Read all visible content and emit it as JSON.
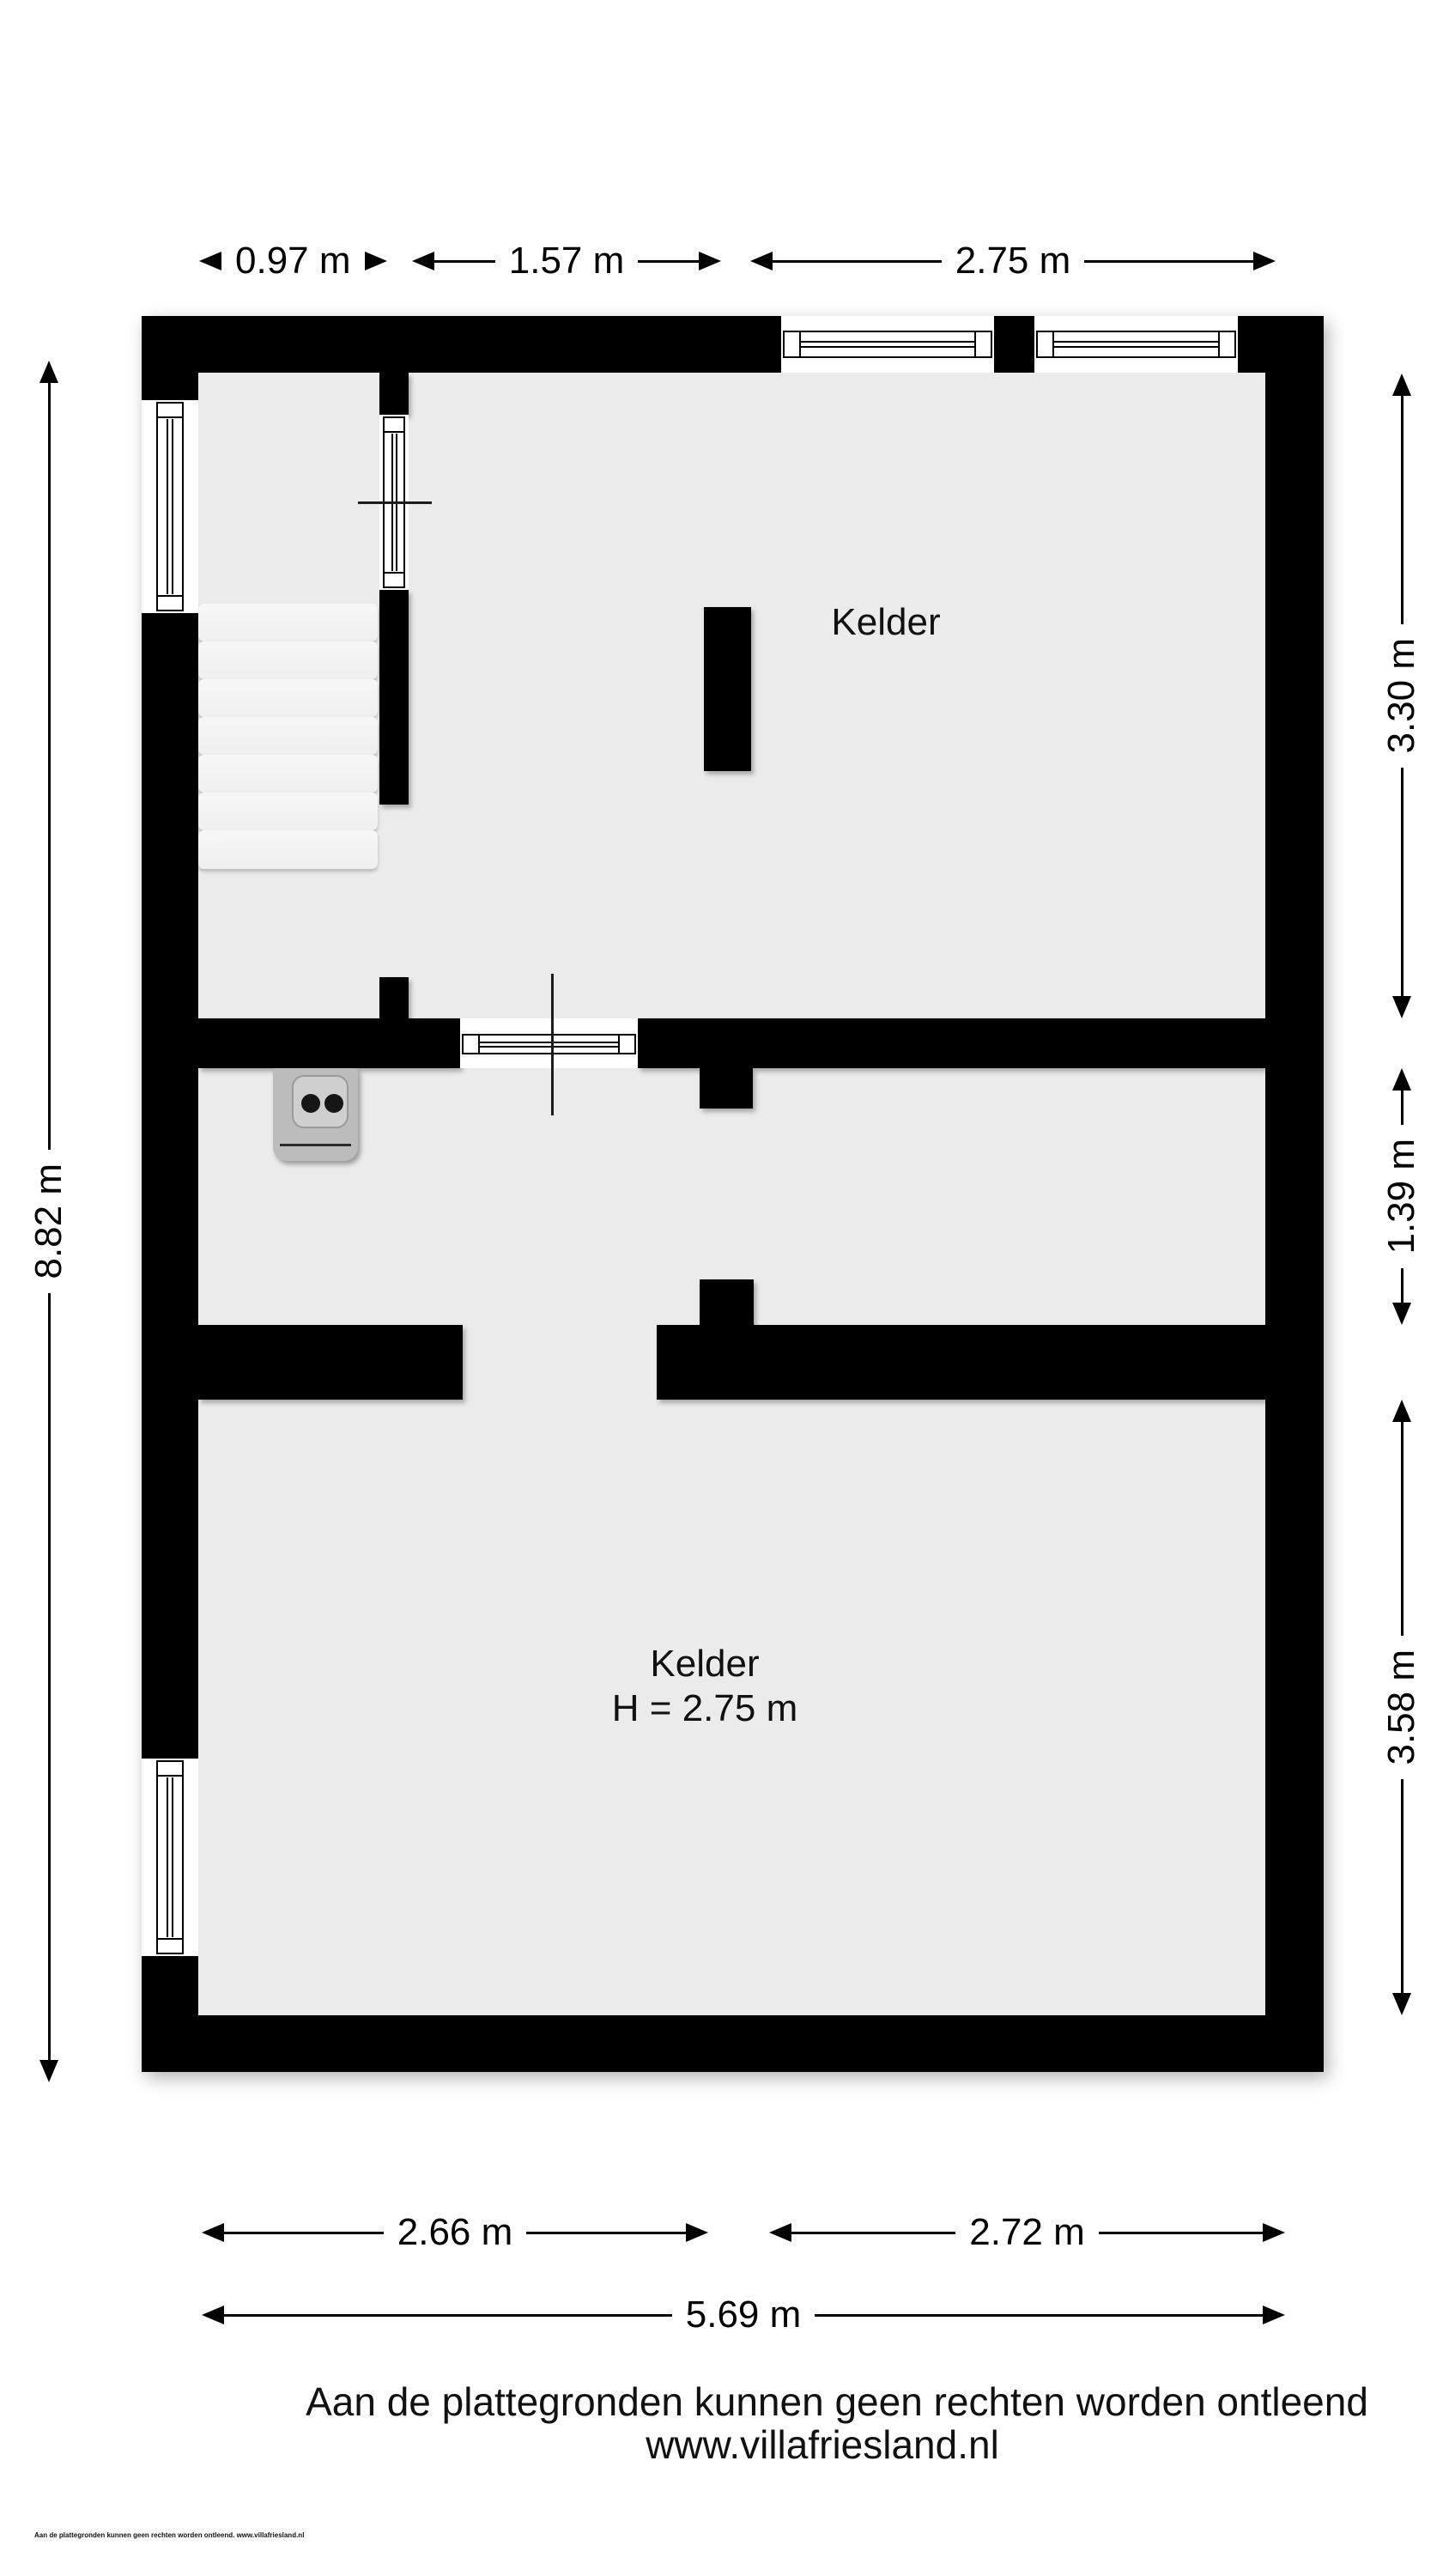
{
  "plan": {
    "rooms": [
      {
        "name": "Kelder"
      },
      {
        "name": "Kelder",
        "height_label": "H = 2.75 m"
      }
    ]
  },
  "dimensions": {
    "top": [
      {
        "label": "0.97 m"
      },
      {
        "label": "1.57 m"
      },
      {
        "label": "2.75 m"
      }
    ],
    "right": [
      {
        "label": "3.30 m"
      },
      {
        "label": "1.39 m"
      },
      {
        "label": "3.58 m"
      }
    ],
    "left": [
      {
        "label": "8.82 m"
      }
    ],
    "bottom": [
      {
        "label": "2.66 m"
      },
      {
        "label": "2.72 m"
      },
      {
        "label": "5.69 m"
      }
    ]
  },
  "footer": {
    "disclaimer": "Aan de plattegronden kunnen geen rechten worden ontleend",
    "website": "www.villafriesland.nl",
    "fine_print": "Aan de plattegronden kunnen geen rechten worden ontleend. www.villafriesland.nl"
  },
  "colors": {
    "wall": "#000000",
    "floor": "#ebebeb",
    "background": "#ffffff",
    "stair_tread": "#f3f3f3",
    "appliance_body": "#bcbcbc",
    "appliance_plate": "#cfcfcf"
  }
}
